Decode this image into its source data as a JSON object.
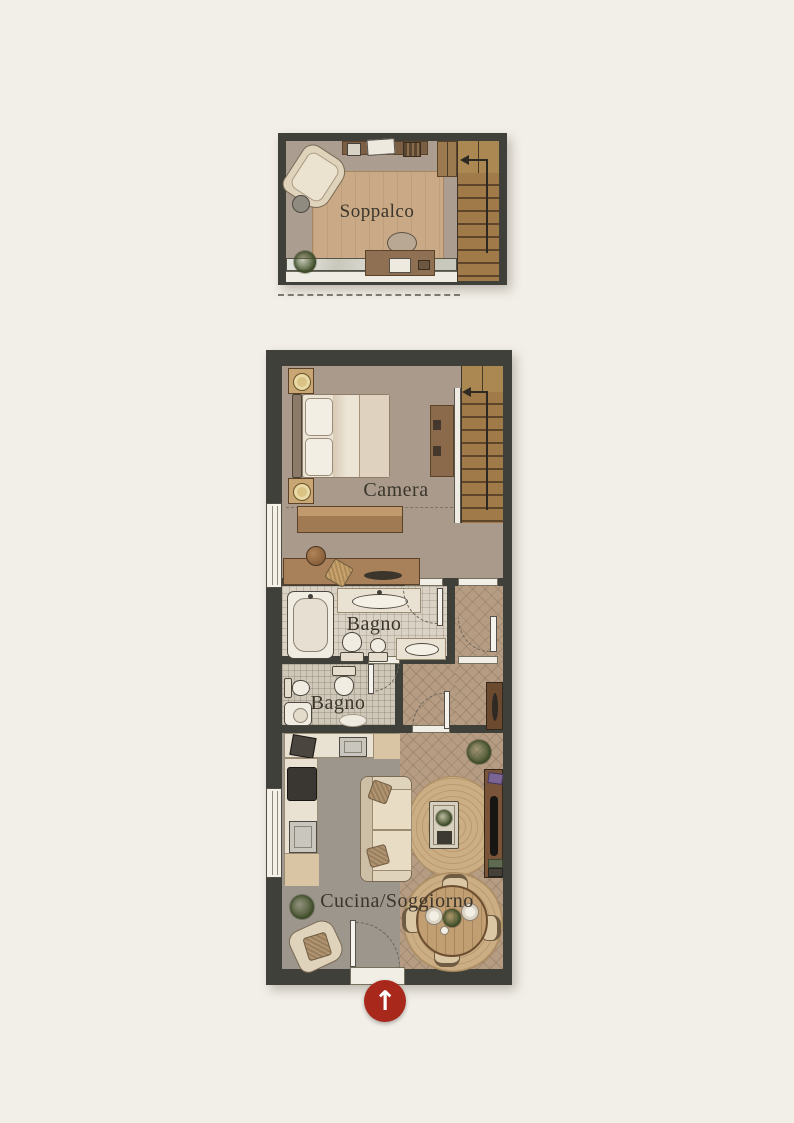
{
  "plan": {
    "type": "apartment-floor-plan",
    "levels": [
      "mezzanine",
      "main-floor"
    ]
  },
  "labels": {
    "soppalco": "Soppalco",
    "camera": "Camera",
    "bagno_1": "Bagno",
    "bagno_2": "Bagno",
    "cucina_soggiorno": "Cucina/Soggiorno"
  },
  "icons": {
    "entrance_arrow": "↑",
    "stairs_direction_main": "left-arrow",
    "stairs_direction_mezzanine": "left-arrow"
  },
  "colors": {
    "page_background": "#f2efe8",
    "wall": "#3f403a",
    "floor_taupe": "#a99a8b",
    "floor_tile": "#d9d2c5",
    "floor_herringbone": "#b59c83",
    "floor_gray": "#9d968c",
    "wood_rug": "#c9a986",
    "stairs_wood": "#8f6a40",
    "entrance_marker_red": "#a9281c",
    "label_text": "#3b362c"
  }
}
